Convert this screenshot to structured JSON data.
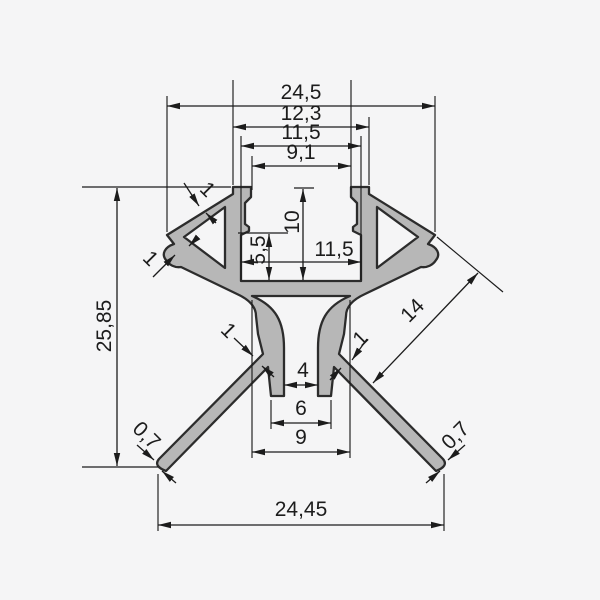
{
  "drawing": {
    "kind": "technical-cross-section",
    "subject": "led-corner-aluminium-profile",
    "colors": {
      "background": "#f5f5f6",
      "profile_fill": "#b7b7b7",
      "outline": "#2c2c2c",
      "dimension_lines": "#1c1c1c"
    },
    "dims": {
      "top_overall": "24,5",
      "top_outer": "12,3",
      "top_inner": "11,5",
      "top_opening": "9,1",
      "depth": "10",
      "step_depth": "5,5",
      "mid_inner": "11,5",
      "height": "25,85",
      "wing_wall_top": "1",
      "wing_wall_side": "1",
      "leg_left": "1",
      "leg_right": "1",
      "leg_length": "14",
      "slot_top": "4",
      "slot_mid": "6",
      "slot_outer": "9",
      "tip_left": "0,7",
      "tip_right": "0,7",
      "bottom_overall": "24,45"
    }
  }
}
